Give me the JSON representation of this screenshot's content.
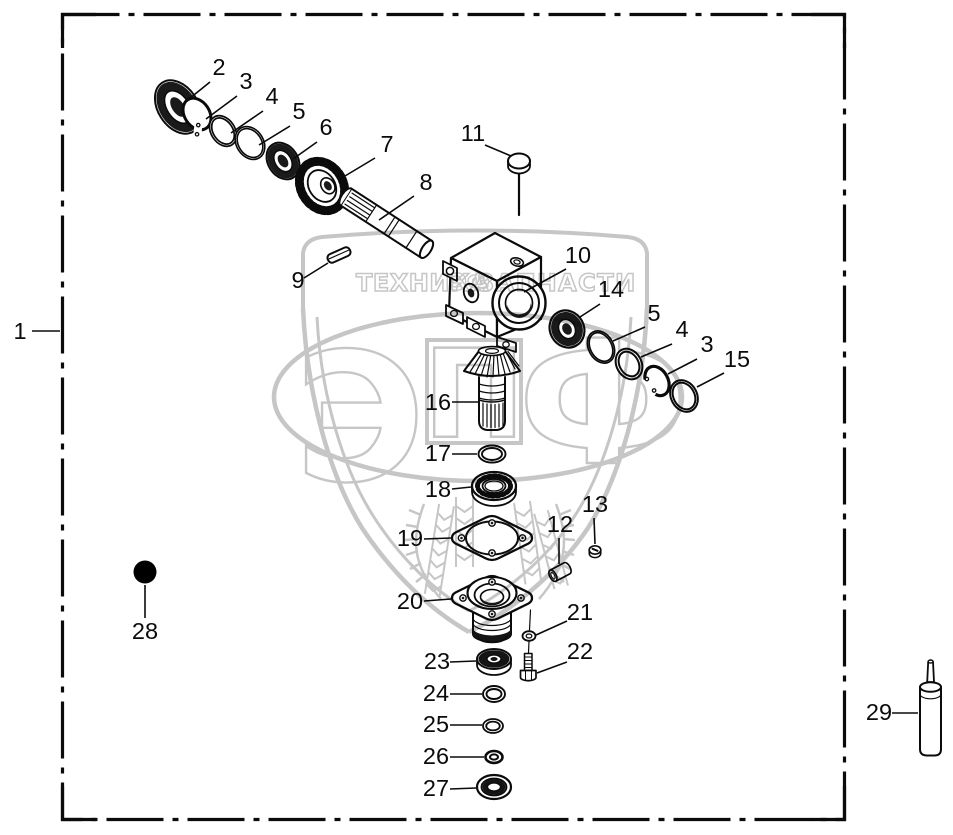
{
  "image_type": "exploded-parts-diagram",
  "palette": {
    "line": "#0b0b0b",
    "background": "#ffffff",
    "dark_fill": "#161616",
    "watermark": "#c6c6c6"
  },
  "watermark": {
    "banner_left": "ТЕХНИКА",
    "banner_right": "ЗАПЧАСТИ",
    "mini_logo": "ЭФ",
    "letters": [
      "Э",
      "П",
      "Ф"
    ],
    "color": "#c6c6c6"
  },
  "callouts": [
    {
      "n": "1",
      "tx": 20,
      "ty": 339,
      "lx1": 32,
      "ly1": 331,
      "lx2": 60,
      "ly2": 331
    },
    {
      "n": "2",
      "tx": 219,
      "ty": 75,
      "lx1": 210,
      "ly1": 82,
      "lx2": 184,
      "ly2": 103
    },
    {
      "n": "3",
      "tx": 246,
      "ty": 89,
      "lx1": 237,
      "ly1": 96,
      "lx2": 206,
      "ly2": 119
    },
    {
      "n": "4",
      "tx": 272,
      "ty": 104,
      "lx1": 263,
      "ly1": 111,
      "lx2": 231,
      "ly2": 133
    },
    {
      "n": "5",
      "tx": 299,
      "ty": 119,
      "lx1": 290,
      "ly1": 126,
      "lx2": 259,
      "ly2": 145
    },
    {
      "n": "6",
      "tx": 326,
      "ty": 135,
      "lx1": 317,
      "ly1": 142,
      "lx2": 293,
      "ly2": 159
    },
    {
      "n": "7",
      "tx": 387,
      "ty": 152,
      "lx1": 375,
      "ly1": 158,
      "lx2": 340,
      "ly2": 179
    },
    {
      "n": "8",
      "tx": 426,
      "ty": 190,
      "lx1": 414,
      "ly1": 196,
      "lx2": 379,
      "ly2": 220
    },
    {
      "n": "9",
      "tx": 298,
      "ty": 288,
      "lx1": 304,
      "ly1": 278,
      "lx2": 328,
      "ly2": 263
    },
    {
      "n": "10",
      "tx": 578,
      "ty": 263,
      "lx1": 566,
      "ly1": 269,
      "lx2": 524,
      "ly2": 292
    },
    {
      "n": "11",
      "tx": 473,
      "ty": 141,
      "lx1": 485,
      "ly1": 145,
      "lx2": 511,
      "ly2": 156
    },
    {
      "n": "14",
      "tx": 611,
      "ty": 297,
      "lx1": 600,
      "ly1": 304,
      "lx2": 580,
      "ly2": 317
    },
    {
      "n": "5",
      "tx": 654,
      "ty": 321,
      "lx1": 645,
      "ly1": 327,
      "lx2": 613,
      "ly2": 341
    },
    {
      "n": "4",
      "tx": 682,
      "ty": 337,
      "lx1": 672,
      "ly1": 344,
      "lx2": 641,
      "ly2": 357
    },
    {
      "n": "3",
      "tx": 707,
      "ty": 352,
      "lx1": 697,
      "ly1": 359,
      "lx2": 668,
      "ly2": 374
    },
    {
      "n": "15",
      "tx": 737,
      "ty": 367,
      "lx1": 724,
      "ly1": 373,
      "lx2": 697,
      "ly2": 387
    },
    {
      "n": "16",
      "tx": 438,
      "ty": 410,
      "lx1": 452,
      "ly1": 402,
      "lx2": 478,
      "ly2": 402
    },
    {
      "n": "17",
      "tx": 438,
      "ty": 461,
      "lx1": 452,
      "ly1": 454,
      "lx2": 477,
      "ly2": 454
    },
    {
      "n": "18",
      "tx": 438,
      "ty": 497,
      "lx1": 452,
      "ly1": 489,
      "lx2": 471,
      "ly2": 487
    },
    {
      "n": "19",
      "tx": 410,
      "ty": 546,
      "lx1": 424,
      "ly1": 539,
      "lx2": 451,
      "ly2": 538
    },
    {
      "n": "20",
      "tx": 410,
      "ty": 609,
      "lx1": 424,
      "ly1": 601,
      "lx2": 451,
      "ly2": 599
    },
    {
      "n": "12",
      "tx": 560,
      "ty": 532,
      "lx1": 559,
      "ly1": 538,
      "lx2": 559,
      "ly2": 564
    },
    {
      "n": "13",
      "tx": 595,
      "ty": 512,
      "lx1": 594,
      "ly1": 518,
      "lx2": 595,
      "ly2": 544
    },
    {
      "n": "21",
      "tx": 580,
      "ty": 620,
      "lx1": 567,
      "ly1": 621,
      "lx2": 536,
      "ly2": 635
    },
    {
      "n": "22",
      "tx": 580,
      "ty": 659,
      "lx1": 567,
      "ly1": 662,
      "lx2": 537,
      "ly2": 673
    },
    {
      "n": "23",
      "tx": 437,
      "ty": 669,
      "lx1": 450,
      "ly1": 662,
      "lx2": 476,
      "ly2": 661
    },
    {
      "n": "24",
      "tx": 436,
      "ty": 701,
      "lx1": 450,
      "ly1": 694,
      "lx2": 482,
      "ly2": 694
    },
    {
      "n": "25",
      "tx": 436,
      "ty": 732,
      "lx1": 450,
      "ly1": 725,
      "lx2": 482,
      "ly2": 725
    },
    {
      "n": "26",
      "tx": 436,
      "ty": 764,
      "lx1": 450,
      "ly1": 757,
      "lx2": 484,
      "ly2": 757
    },
    {
      "n": "27",
      "tx": 436,
      "ty": 796,
      "lx1": 450,
      "ly1": 789,
      "lx2": 476,
      "ly2": 788
    },
    {
      "n": "28",
      "tx": 145,
      "ty": 639,
      "lx1": 145,
      "ly1": 618,
      "lx2": 145,
      "ly2": 585
    },
    {
      "n": "29",
      "tx": 879,
      "ty": 720,
      "lx1": 892,
      "ly1": 713,
      "lx2": 918,
      "ly2": 713
    }
  ]
}
